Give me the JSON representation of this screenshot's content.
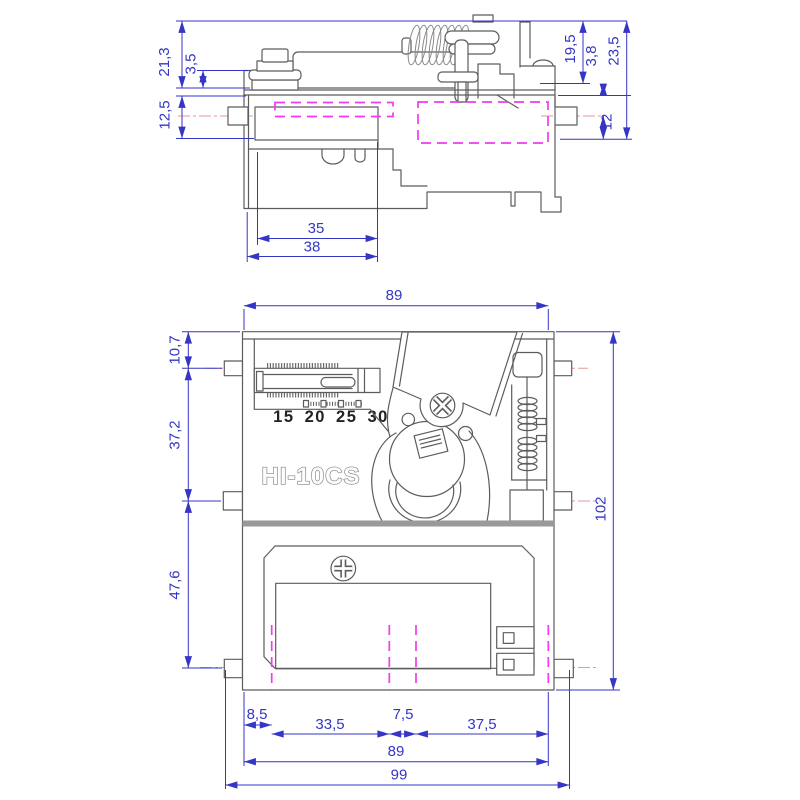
{
  "device": {
    "model": "HI-10CS",
    "coin_values": "15 20 25 30"
  },
  "colors": {
    "dimension_blue": "#3535c6",
    "outline_gray": "#5c5c5c",
    "hidden_detail_magenta": "#ee3cee",
    "centerline_red": "#e59a9a",
    "label_black": "#222222"
  },
  "side_view": {
    "dims": {
      "total_height": "21,3",
      "step_height": "3,5",
      "pin_offset": "12,5",
      "right_height": "19,5",
      "right_step": "3,8",
      "right_total_height": "23,5",
      "right_pin_offset": "12",
      "inner_depth": "35",
      "outer_depth": "38"
    }
  },
  "front_view": {
    "dims": {
      "top_width": "89",
      "top_pin_offset": "10,7",
      "pin_spacing_upper": "37,2",
      "pin_spacing_lower": "47,6",
      "total_height": "102",
      "bottom_left_offset": "8,5",
      "bottom_left_span": "33,5",
      "bottom_center_gap": "7,5",
      "bottom_right_span": "37,5",
      "body_width": "89",
      "total_width": "99"
    }
  }
}
